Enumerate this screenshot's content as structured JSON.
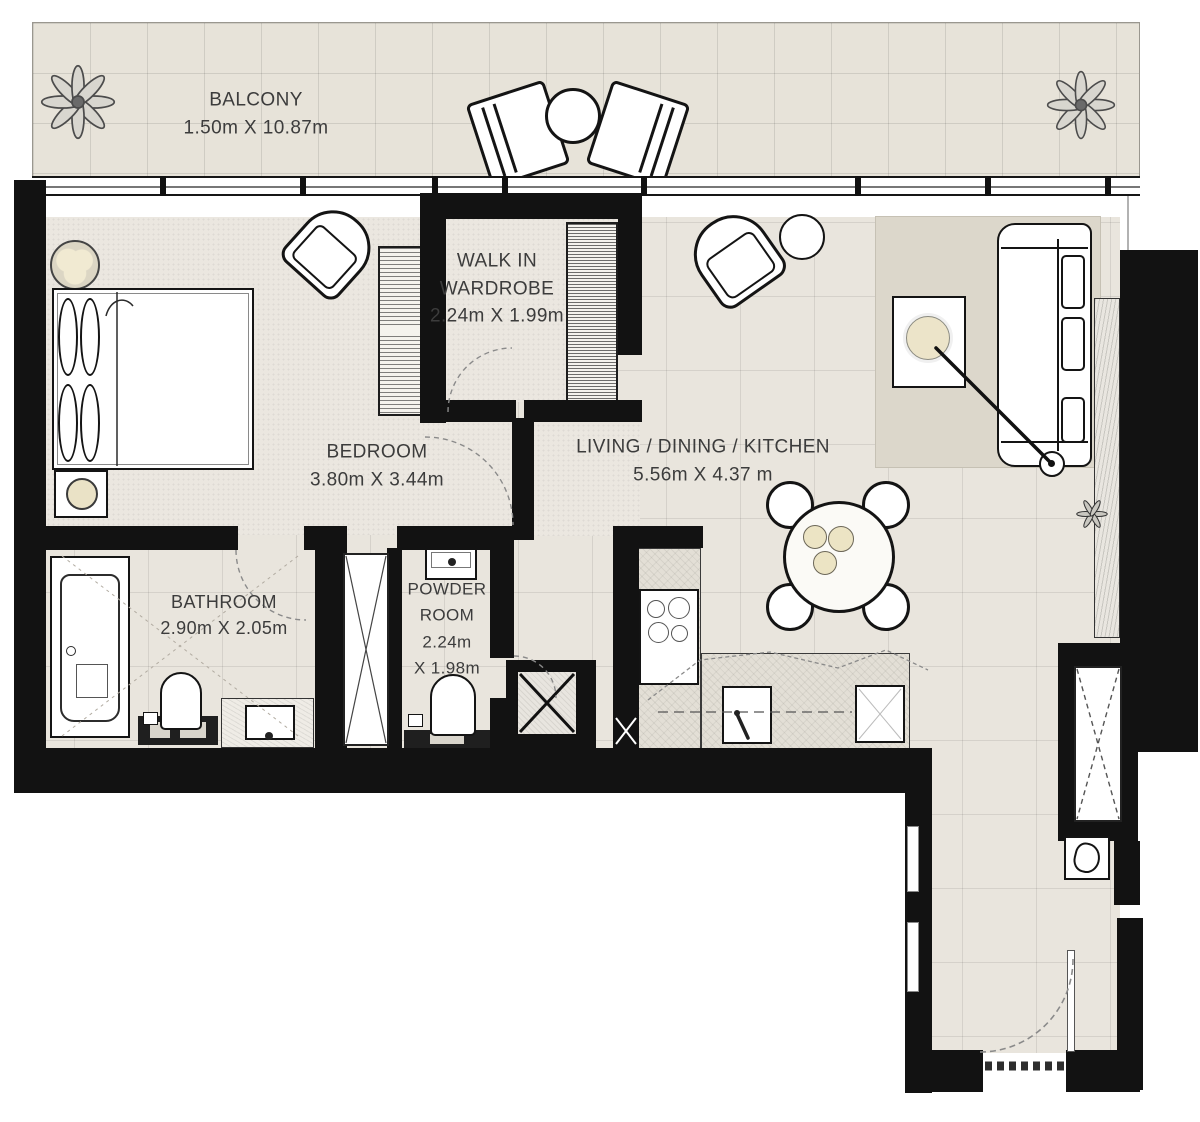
{
  "rooms": {
    "balcony": {
      "name": "BALCONY",
      "dims": "1.50m X 10.87m"
    },
    "walk_in_wardrobe": {
      "name_line1": "WALK IN",
      "name_line2": "WARDROBE",
      "dims": "2.24m X 1.99m"
    },
    "bedroom": {
      "name": "BEDROOM",
      "dims": "3.80m X 3.44m"
    },
    "living_dining_kitchen": {
      "name": "LIVING / DINING / KITCHEN",
      "dims": "5.56m X 4.37 m"
    },
    "bathroom": {
      "name": "BATHROOM",
      "dims": "2.90m X 2.05m"
    },
    "powder_room": {
      "name_line1": "POWDER",
      "name_line2": "ROOM",
      "dims_line1": "2.24m",
      "dims_line2": "X 1.98m"
    }
  },
  "colors": {
    "wall": "#121212",
    "floor_tile": "#e9e5dd",
    "floor_carpet": "#ebe7e0",
    "balcony_floor": "#e7e3d9",
    "rug": "#dcd7cb",
    "accent_beige": "#ece4c4",
    "label_text": "#3c3c3c"
  }
}
